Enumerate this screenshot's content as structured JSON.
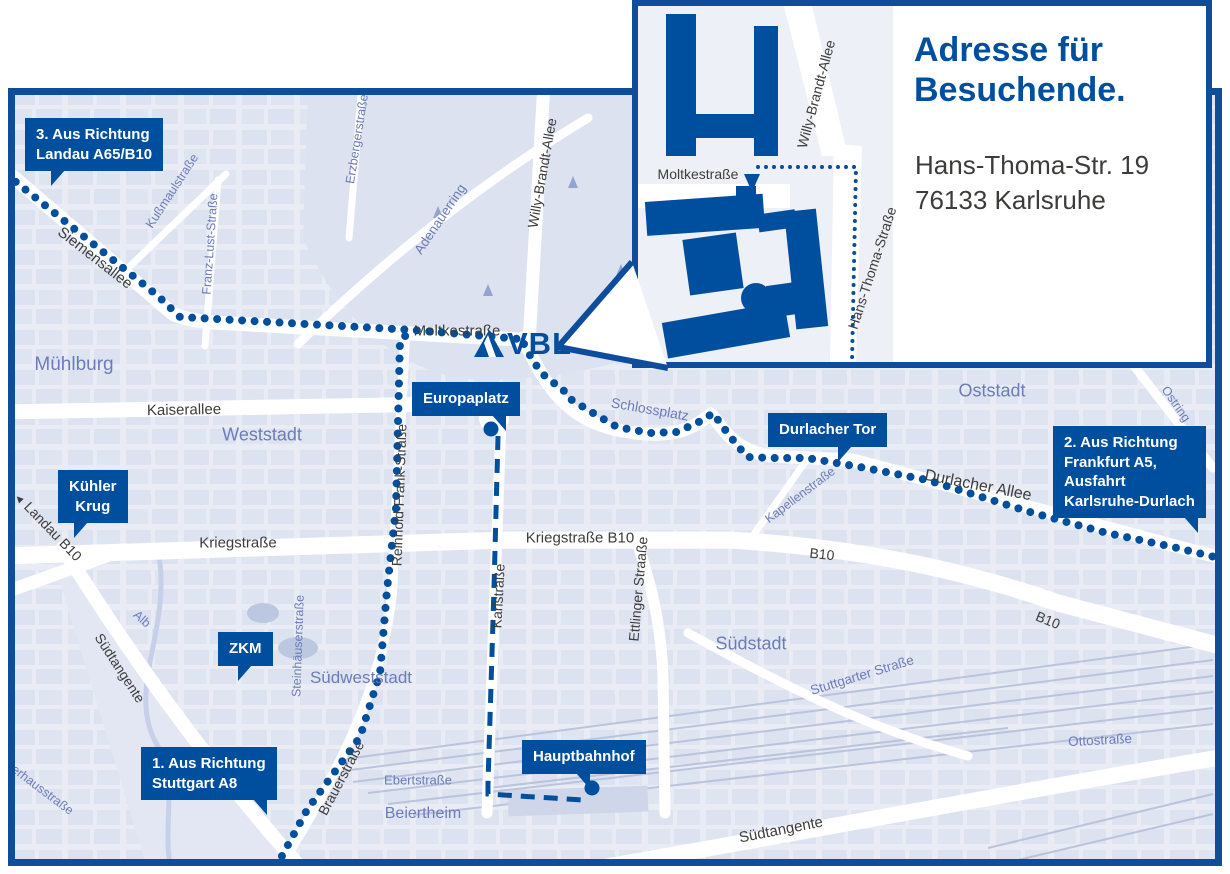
{
  "colors": {
    "primary_blue": "#004F9F",
    "border_blue": "#0e4c9c",
    "map_background": "#e9ecf5",
    "city_block": "#d7ddee",
    "label_blue": "#6b7cb7",
    "label_dark": "#3d3d3c",
    "road_white": "#ffffff",
    "railway": "#b6c0da",
    "water": "#c6d0e8"
  },
  "logo": {
    "text": "VBL"
  },
  "inset": {
    "title": "Adresse für\nBesuchende.",
    "address": "Hans-Thoma-Str. 19\n76133 Karlsruhe",
    "street_labels": {
      "moltkestrasse": "Moltkestraße",
      "willy_brandt_allee": "Willy-Brandt-Allee",
      "hans_thoma_strasse": "Hans-Thoma-Straße"
    }
  },
  "callouts": {
    "landau": "3. Aus Richtung\nLandau A65/B10",
    "frankfurt": "2. Aus Richtung\nFrankfurt A5,\nAusfahrt\nKarlsruhe-Durlach",
    "stuttgart": "1. Aus Richtung\nStuttgart A8",
    "kuehler_krug": "Kühler\nKrug",
    "zkm": "ZKM",
    "europaplatz": "Europaplatz",
    "durlacher_tor": "Durlacher Tor",
    "hauptbahnhof": "Hauptbahnhof"
  },
  "streets": {
    "siemensallee": "Siemensallee",
    "moltkestrasse": "Moltkestraße",
    "kaiserallee": "Kaiserallee",
    "willy_brandt_allee": "Willy-Brandt-Allee",
    "kriegstrasse": "Kriegstraße",
    "kriegstrasse_b10": "Kriegstraße B10",
    "karlstrasse": "Karlstraße",
    "ettlinger_strasse": "Ettlinger Straaße",
    "reinhold_frank_strasse": "Reinhold-Frank-Straße",
    "durlacher_allee": "Durlacher Allee",
    "b10_west": "B10",
    "b10_east": "B10",
    "landau_b10_arrow": "◄",
    "landau_b10": "Landau B10",
    "suedtangente_west": "Südtangente",
    "suedtangente_sued": "Südtangente",
    "brauerstrasse": "Brauerstraße"
  },
  "areas": {
    "muehlburg": "Mühlburg",
    "weststadt": "Weststadt",
    "oststadt": "Oststadt",
    "suedstadt": "Südstadt",
    "suedweststadt": "Südweststadt",
    "beiertheim": "Beiertheim",
    "ebertstrasse": "Ebertstraße",
    "ottostrasse": "Ottostraße",
    "stuttgarter_strasse": "Stuttgarter Straße",
    "adenauerring": "Adenauerring",
    "alb": "Alb",
    "steinhaeuserstrasse": "Steinhäuserstraße",
    "kapellenstrasse": "Kapellenstraße",
    "schlossplatz": "Schlossplatz",
    "ostring": "Ostring",
    "kussmaulstrasse": "Kußmaulstraße",
    "franz_lust_strasse": "Franz-Lust-Straße",
    "erzbergerstrasse": "Erzbergerstraße",
    "verhausstrasse": "verhausstraße"
  }
}
